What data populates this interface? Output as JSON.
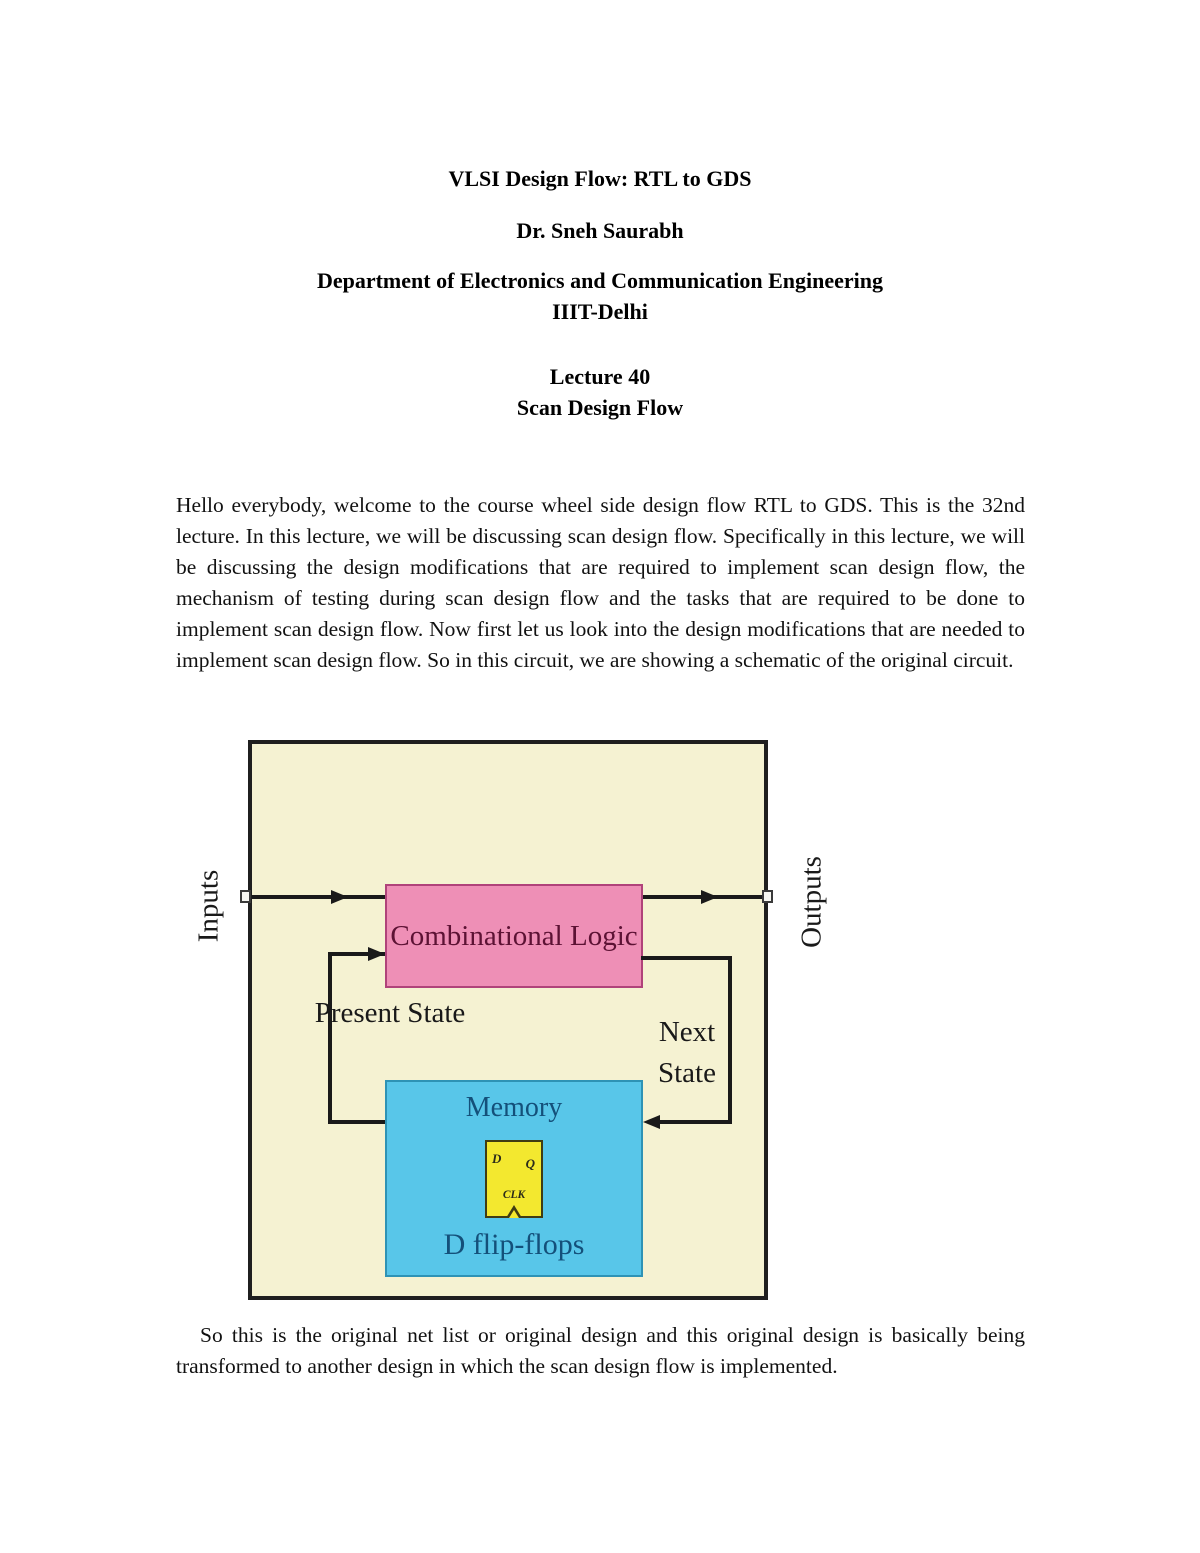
{
  "header": {
    "title": "VLSI Design Flow: RTL to GDS",
    "author": "Dr. Sneh Saurabh",
    "department": "Department of Electronics and Communication Engineering",
    "institute": "IIIT-Delhi",
    "lecture_number": "Lecture 40",
    "lecture_title": "Scan Design Flow"
  },
  "body": {
    "paragraph_1": "Hello everybody, welcome to the course wheel side design flow RTL to GDS.  This is the 32nd lecture.  In this lecture, we will be discussing scan design flow.  Specifically in this lecture, we will be discussing the design modifications that are required to implement scan design flow, the mechanism of testing during scan design flow and the tasks that are required to be done to implement scan design flow.  Now first let us look into the design modifications that are needed to implement scan design flow.  So in this circuit, we are showing a schematic of the original circuit.",
    "paragraph_2": "So this is the original net list or original design and this original design is basically being transformed to another design in which the scan design flow is implemented."
  },
  "diagram": {
    "inputs_label": "Inputs",
    "outputs_label": "Outputs",
    "combinational_logic_label": "Combinational Logic",
    "present_state_label": "Present State",
    "next_state_label": "Next State",
    "memory_label": "Memory",
    "d_flip_flops_label": "D flip-flops",
    "flip_flop": {
      "d": "D",
      "q": "Q",
      "clk": "CLK"
    },
    "colors": {
      "canvas_fill": "#f5f2d2",
      "canvas_border": "#1f1f1f",
      "combinational_fill": "#ee8fb6",
      "combinational_border": "#b0437a",
      "combinational_text": "#5c1234",
      "memory_fill": "#58c6e9",
      "memory_border": "#2e93b5",
      "memory_text": "#14507a",
      "flipflop_fill": "#f3e82f",
      "flipflop_border": "#403c12",
      "wire": "#1a1a1a"
    }
  }
}
